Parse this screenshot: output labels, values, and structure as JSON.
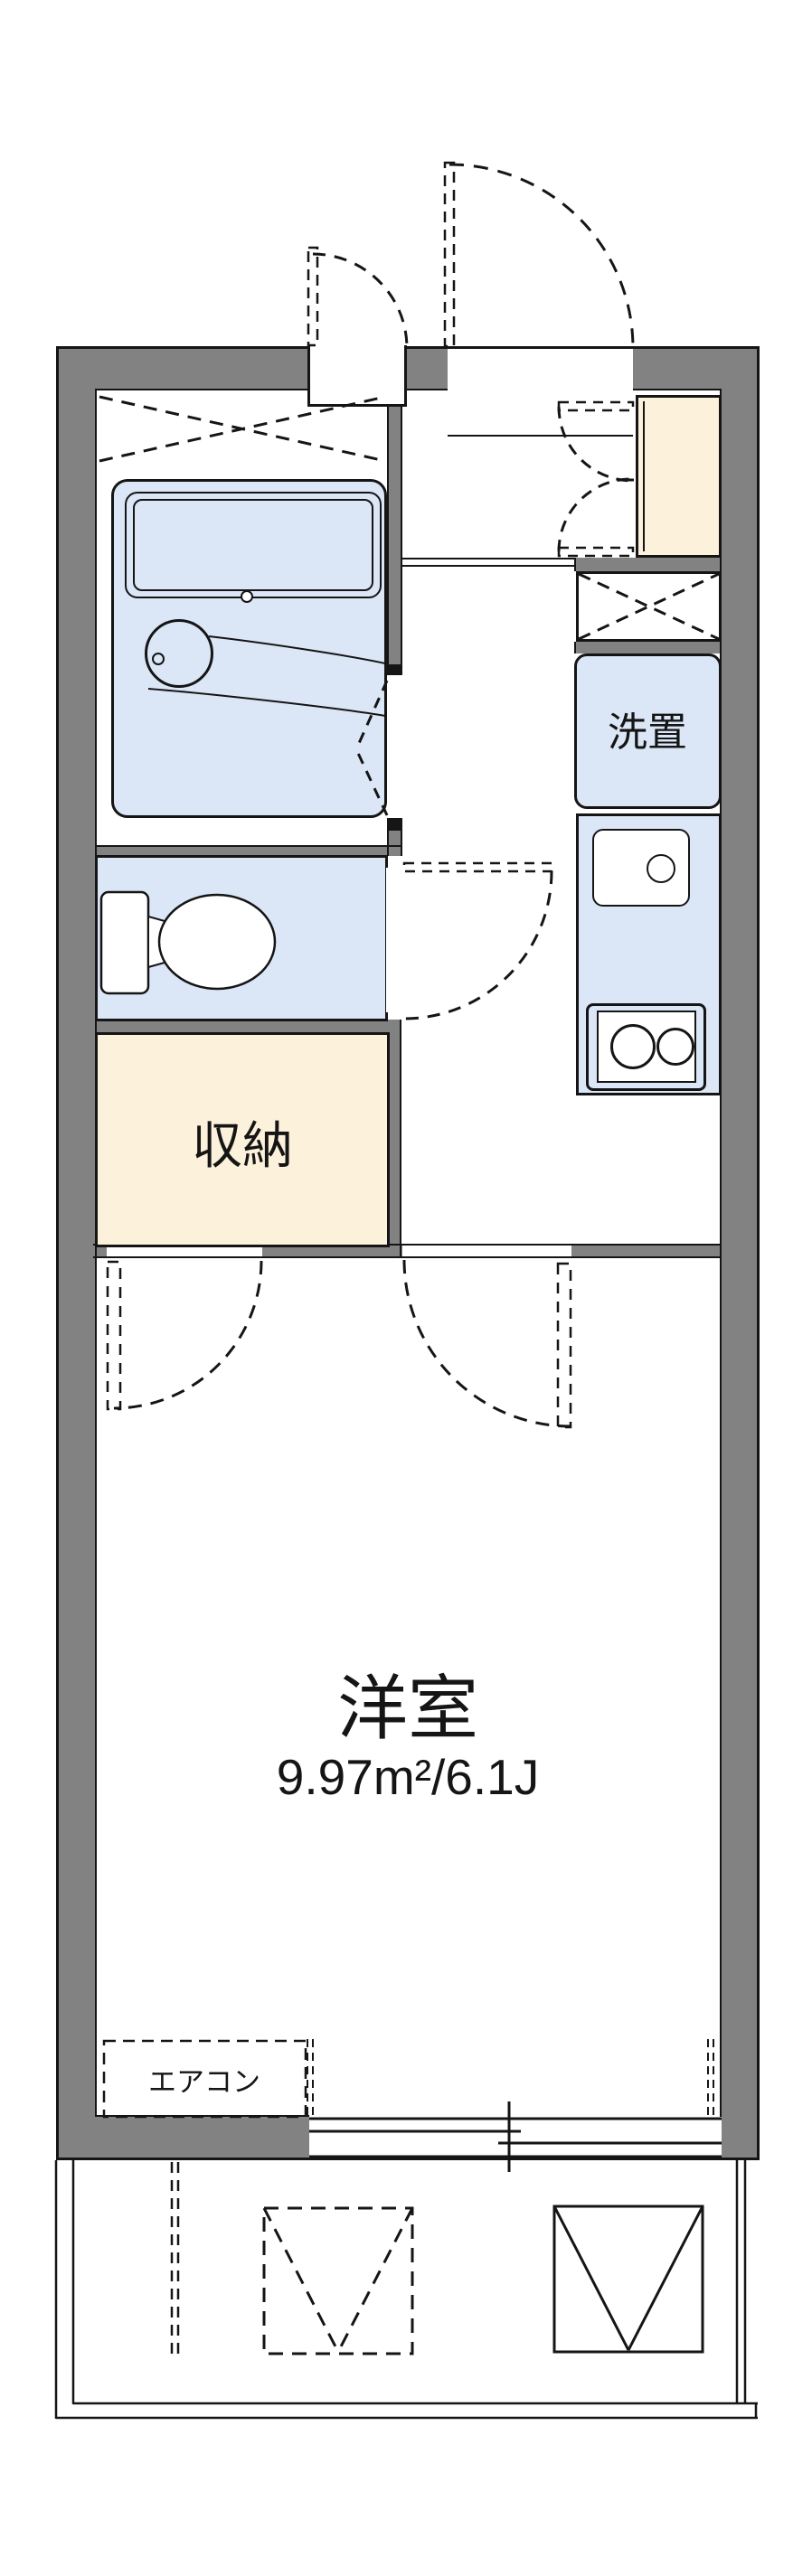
{
  "document": {
    "type": "floor-plan",
    "title": "1K apartment floor plan"
  },
  "colors": {
    "wall_gray": "#828282",
    "line_black": "#151515",
    "fixture_blue": "#dbe6f7",
    "closet_cream": "#fcf1da",
    "background": "#ffffff"
  },
  "labels": {
    "main_room_name": "洋室",
    "main_room_area": "9.97m²/6.1J",
    "storage": "収納",
    "washer_space": "洗置",
    "air_conditioner": "エアコン"
  },
  "symbols": {
    "bath": "unit-bath with tub and wash basin",
    "toilet": "toilet with tank",
    "kitchen": "sink and two-burner stove",
    "doors": "dashed swing arcs",
    "window": "sliding window on south wall",
    "balcony": "balcony with evacuation hatch symbols"
  }
}
